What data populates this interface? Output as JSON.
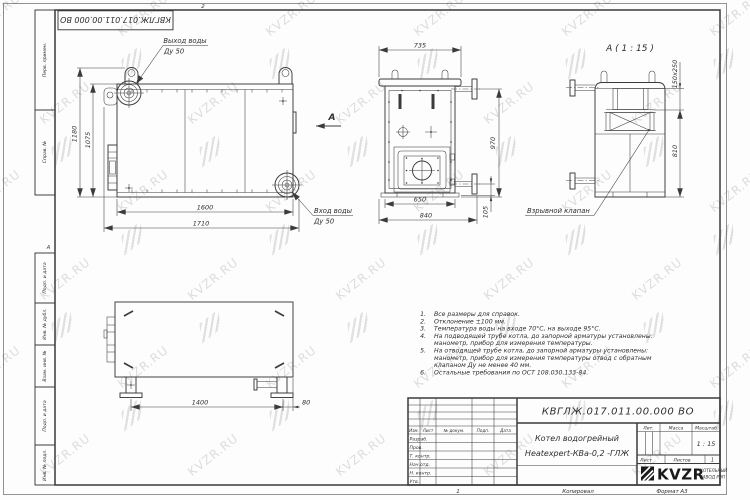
{
  "watermark": {
    "text": "KVZR.RU"
  },
  "sheet": {
    "top_stamp": "КВГЛЖ.017.011.00.000 ВО",
    "top_fold_mark": "2",
    "zone_letter": "А",
    "side_labels": {
      "perv_primen": "Перв. примен.",
      "sprav_no": "Справ. №",
      "podp_data_1": "Подп. и дата",
      "inv_dubl": "Инв. № дубл.",
      "vzam_inv": "Взам. инв. №",
      "podp_data_2": "Подп. и дата",
      "inv_podl": "Инв. № подл."
    },
    "footer": {
      "sheet_no": "1",
      "copied": "Копировал",
      "format": "Формат А3"
    }
  },
  "views": {
    "front": {
      "dims": {
        "height_overall": "1180",
        "height_body": "1075",
        "length_body": "1600",
        "length_overall": "1710"
      },
      "labels": {
        "outlet": "Выход воды",
        "outlet_dn": "Ду 50",
        "inlet": "Вход воды",
        "inlet_dn": "Ду 50",
        "view_mark": "А"
      }
    },
    "side": {
      "dims": {
        "width_top": "735",
        "height": "970",
        "width_body": "650",
        "width_overall": "840",
        "offset": "105"
      }
    },
    "detail": {
      "title": "А ( 1 : 15 )",
      "dims": {
        "size": "150x250",
        "height": "810"
      },
      "label_valve": "Взрывной клапан"
    },
    "rear": {
      "dims": {
        "span": "1400",
        "offset": "80"
      }
    }
  },
  "notes": {
    "lines": [
      {
        "n": "1.",
        "t": "Все размеры для справок."
      },
      {
        "n": "2.",
        "t": "Отклонение ±100 мм."
      },
      {
        "n": "3.",
        "t": "Температура воды на входе 70°С, на выходе 95°С."
      },
      {
        "n": "4.",
        "t": "На подводящей трубе котла, до запорной арматуры установлены:"
      },
      {
        "n": "",
        "t": "манометр, прибор для измерения температуры."
      },
      {
        "n": "5.",
        "t": "На отводящей трубе котла, до запорной арматуры установлены:"
      },
      {
        "n": "",
        "t": "манометр, прибор для измерения температуры  отвод с обратным"
      },
      {
        "n": "",
        "t": "клапаном Ду не менее 40 мм."
      },
      {
        "n": "6.",
        "t": "Остальные требования по ОСТ 108.030.133-84."
      }
    ]
  },
  "title_block": {
    "designation": "КВГЛЖ.017.011.00.000 ВО",
    "product_name_line1": "Котел водогрейный",
    "product_name_line2": "Heatexpert-КВа-0,2 -ГЛЖ",
    "headers": {
      "izm": "Изм.",
      "list": "Лист",
      "doc_no": "№ докум.",
      "podp": "Подп.",
      "data": "Дата"
    },
    "rows": [
      "Разраб.",
      "Пров.",
      "Т. контр.",
      "Нач.отд.",
      "Н. контр.",
      "Утв."
    ],
    "lit_label": "Лит.",
    "mass_label": "Масса",
    "scale_label": "Масштаб",
    "scale_value": "1 : 15",
    "sheet_label": "Лист",
    "sheets_label": "Листов",
    "sheets_value": "1",
    "logo": {
      "text": "KVZR",
      "sub_line1": "КОТЕЛЬНЫЙ",
      "sub_line2": "ЗАВОД РЭП"
    }
  }
}
